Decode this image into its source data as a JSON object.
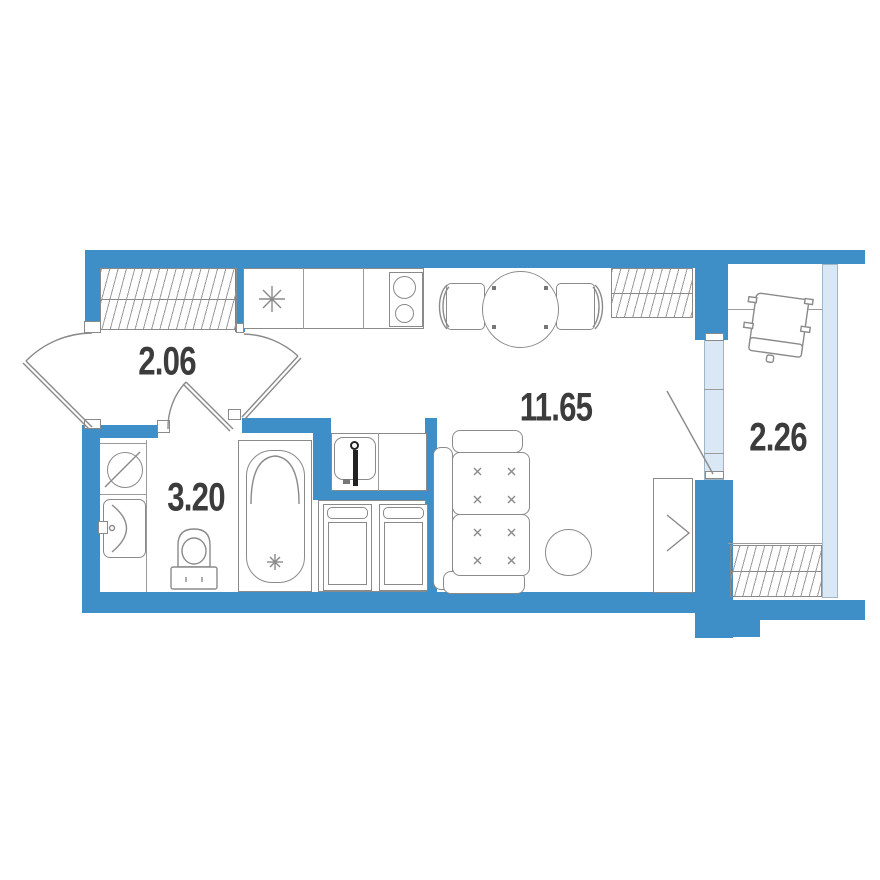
{
  "plan": {
    "rooms": [
      {
        "name": "hallway",
        "area": "2.06"
      },
      {
        "name": "bathroom",
        "area": "3.20"
      },
      {
        "name": "living-room",
        "area": "11.65"
      },
      {
        "name": "balcony",
        "area": "2.26"
      }
    ],
    "colors": {
      "wall": "#3E8EC7",
      "glazing": "#D9E8F4",
      "line": "#8A8A8A",
      "hatch": "#9A9A9A",
      "label": "#3C3C3C",
      "background": "#FFFFFF",
      "fixture_dark": "#222222"
    },
    "icons": [
      "entry-door-icon",
      "wardrobe-hatch-icon",
      "kitchen-sink-icon",
      "stove-icon",
      "dining-table-icon",
      "dining-chair-icon",
      "washing-machine-icon",
      "washbasin-icon",
      "toilet-icon",
      "bathtub-icon",
      "utility-sink-icon",
      "cabinet-icon",
      "sofa-icon",
      "pouf-icon",
      "wardrobe-icon",
      "balcony-door-icon",
      "balcony-chair-icon",
      "balcony-glazing-icon"
    ]
  }
}
